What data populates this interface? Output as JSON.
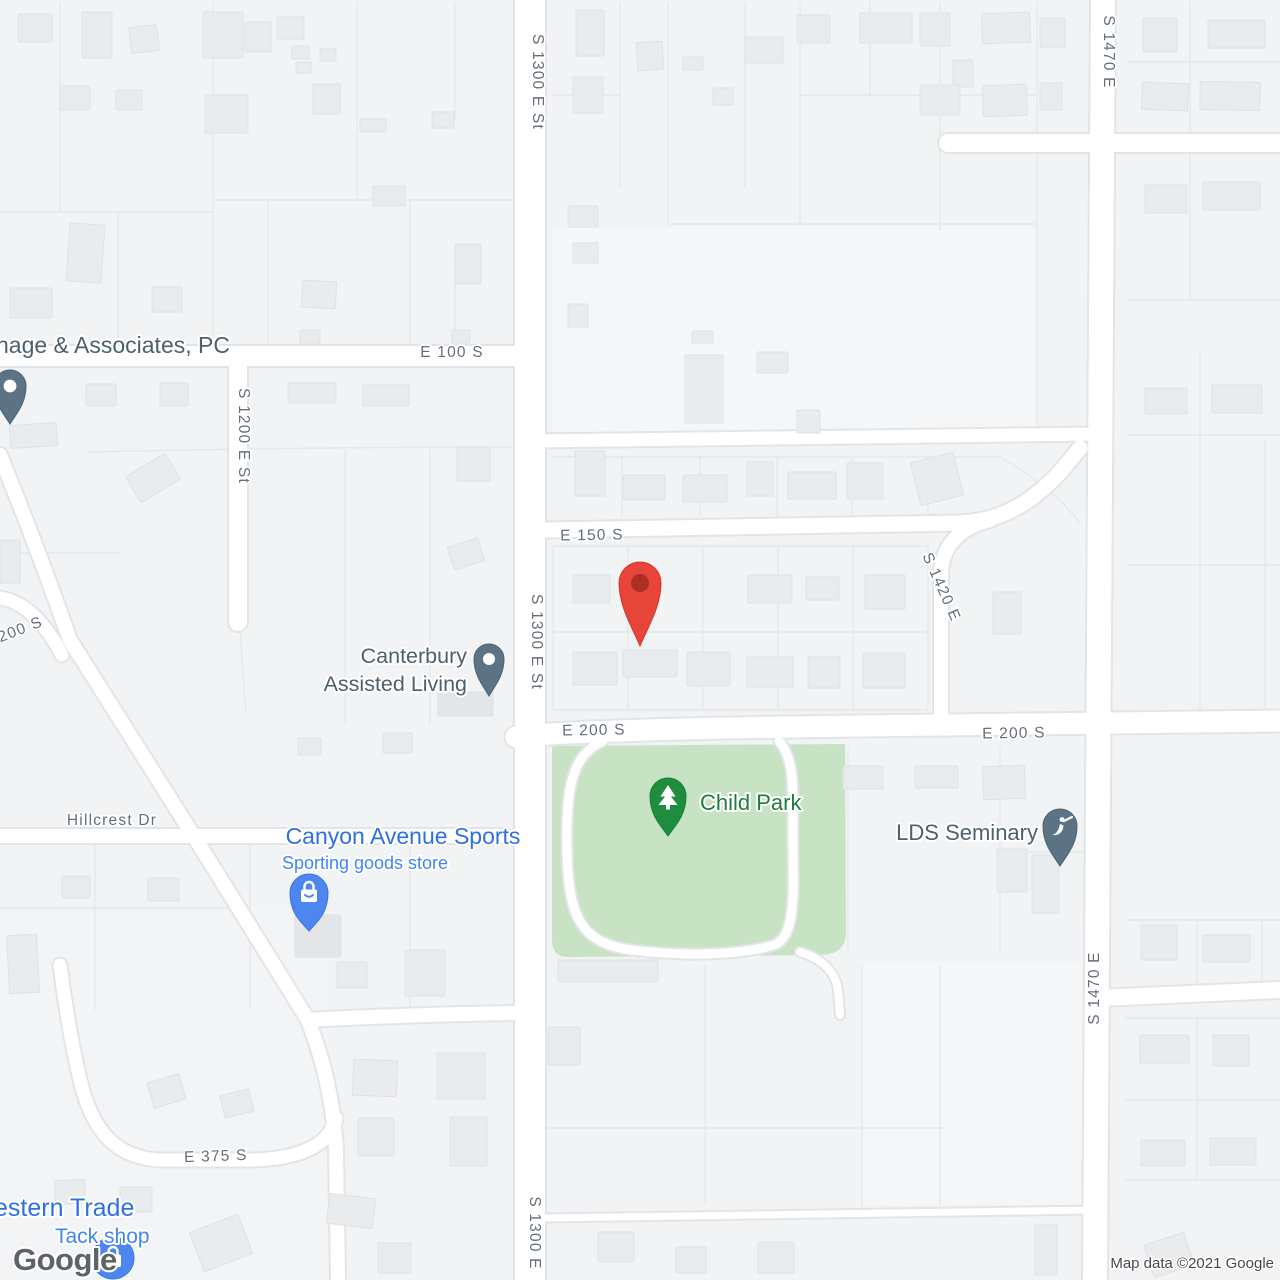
{
  "map": {
    "colors": {
      "bg": "#f1f3f4",
      "zoneLight": "#f6f7f8",
      "parcel": "#e5e8ea",
      "casing": "#e2e5e8",
      "road": "#ffffff",
      "park": "#c8e3c3",
      "building": "#eaebed",
      "buildingStroke": "#dfe1e4",
      "buildingDark": "#e3e5e7",
      "streetLabel": "#646e78",
      "halo": "#ffffff",
      "poiSlate": "#4d606c",
      "poiGreen": "#1e7d3c",
      "poiBlue": "#2f6fe0",
      "poiBlueLight": "#4285f4",
      "pinSlate": "#5b7384",
      "pinSlateStroke": "#4c6170",
      "pinGreen": "#1e8e3e",
      "pinGreenStroke": "#17803a",
      "pinBlue": "#4e86f0",
      "pinBlueStroke": "#3a74e0",
      "markerRed": "#e8453a",
      "markerRedStroke": "#d03b2e",
      "markerRedInner": "#ad2e24",
      "logoGray": "#5f6368",
      "attribution": "#45494d"
    },
    "zones": [
      {
        "x": 553,
        "y": 228,
        "w": 484,
        "h": 204,
        "f": "#f5f6f7"
      },
      {
        "x": 862,
        "y": 962,
        "w": 226,
        "h": 243,
        "f": "#f5f6f7"
      },
      {
        "x": 0,
        "y": 908,
        "w": 328,
        "h": 372,
        "f": "#f3f4f6"
      }
    ],
    "parcel_lines": [
      "M60,2V212",
      "M213,2V343",
      "M357,2V200",
      "M455,2V120",
      "M0,212H213",
      "M213,200H516",
      "M118,212V345",
      "M268,200V345",
      "M410,200V345",
      "M455,260V345",
      "M88,452C220,449 390,447 516,447",
      "M345,450V725",
      "M430,450V725",
      "M240,622C242,668 244,690 246,712",
      "M0,553H120",
      "M0,908H250",
      "M95,844V1010",
      "M250,844V1008",
      "M410,844V1010",
      "M553,457H1002",
      "M622,457V517",
      "M700,457V517",
      "M777,457V517",
      "M852,457V517",
      "M928,457V517",
      "M1003,459C1040,480 1062,500 1080,523",
      "M553,546H928",
      "M553,546V710",
      "M628,546V710",
      "M703,546V710",
      "M778,546V710",
      "M853,546V710",
      "M928,546V710",
      "M553,632H928",
      "M553,710H928",
      "M620,2V188",
      "M668,2V224",
      "M745,2V188",
      "M800,2V224",
      "M870,2V95",
      "M940,2V230",
      "M1037,2V432",
      "M668,224H1037",
      "M800,95H1037",
      "M553,95H620",
      "M1128,62H1280",
      "M1190,2V138",
      "M1128,300H1280",
      "M1190,152V300",
      "M1128,435H1280",
      "M1200,350V715",
      "M1128,565H1280",
      "M1265,440V715",
      "M1125,920H1280",
      "M1197,920V993",
      "M1262,920V993",
      "M1125,1018H1280",
      "M1197,1018V1098",
      "M1125,1100H1280",
      "M1197,1100V1180",
      "M1125,1180H1280",
      "M545,1128H945",
      "M705,965V1205",
      "M862,965V1205",
      "M940,965V1205",
      "M1000,748V952",
      "M1000,852H1092",
      "M848,748V952"
    ],
    "park": {
      "d": "M552,746 L845,744 L846,930 C846,948 838,954 820,955 L568,957 C556,957 552,950 552,938 Z"
    },
    "roads": [
      {
        "d": "M530,0 V1280",
        "w": 30
      },
      {
        "d": "M1103,0 L1095,1280",
        "w": 24
      },
      {
        "d": "M0,356 H516",
        "w": 20
      },
      {
        "d": "M948,143 H1280",
        "w": 18
      },
      {
        "d": "M530,441 L1100,434",
        "w": 13
      },
      {
        "d": "M545,530 L960,523 C1000,521 1030,505 1062,470 L1080,448",
        "w": 15
      },
      {
        "d": "M941,716 V575 C941,548 958,528 990,520",
        "w": 14
      },
      {
        "d": "M516,737 C560,731 700,728 860,726 L1280,721",
        "w": 21
      },
      {
        "d": "M238,357 V622",
        "w": 18
      },
      {
        "d": "M0,836 H505",
        "w": 14
      },
      {
        "d": "M0,455 C30,530 45,570 70,640 L210,862 L308,1020",
        "w": 14
      },
      {
        "d": "M0,598 C25,602 45,622 62,655",
        "w": 13
      },
      {
        "d": "M308,1020 C380,1016 450,1014 516,1013",
        "w": 14
      },
      {
        "d": "M308,1020 C325,1065 333,1100 336,1150 L338,1280",
        "w": 14
      },
      {
        "d": "M336,1118 C330,1146 300,1158 255,1160 L160,1160 C115,1158 92,1130 80,1080 C72,1045 65,1005 60,965",
        "w": 13
      },
      {
        "d": "M1099,998 L1280,990",
        "w": 16
      },
      {
        "d": "M545,1218 L1097,1210",
        "w": 7
      },
      {
        "d": "M603,741 C571,755 566,790 567,848 C568,912 578,940 625,949 C685,958 745,954 774,945 C794,938 794,900 793,852 C792,795 797,762 779,741",
        "w": 9
      },
      {
        "d": "M800,952 C820,958 835,970 838,990 L840,1015",
        "w": 8
      }
    ],
    "buildings": [
      [
        18,
        14,
        34,
        28,
        0
      ],
      [
        82,
        12,
        30,
        46,
        0
      ],
      [
        130,
        26,
        28,
        26,
        -7
      ],
      [
        203,
        12,
        40,
        46,
        0
      ],
      [
        245,
        22,
        26,
        30,
        0
      ],
      [
        277,
        17,
        27,
        22,
        0
      ],
      [
        292,
        46,
        17,
        13,
        0
      ],
      [
        320,
        49,
        16,
        12,
        0
      ],
      [
        296,
        62,
        15,
        11,
        0
      ],
      [
        60,
        86,
        30,
        24,
        0
      ],
      [
        116,
        90,
        26,
        20,
        0
      ],
      [
        205,
        95,
        43,
        38,
        0
      ],
      [
        313,
        84,
        27,
        30,
        0
      ],
      [
        360,
        119,
        26,
        13,
        0
      ],
      [
        432,
        112,
        22,
        16,
        0
      ],
      [
        373,
        186,
        32,
        20,
        0
      ],
      [
        68,
        224,
        35,
        58,
        4
      ],
      [
        10,
        288,
        42,
        30,
        0
      ],
      [
        152,
        287,
        30,
        25,
        0
      ],
      [
        302,
        281,
        34,
        27,
        3
      ],
      [
        455,
        244,
        26,
        40,
        0
      ],
      [
        300,
        330,
        20,
        13,
        0
      ],
      [
        452,
        330,
        18,
        13,
        0
      ],
      [
        86,
        384,
        30,
        22,
        0
      ],
      [
        160,
        383,
        28,
        23,
        0
      ],
      [
        288,
        383,
        48,
        20,
        0
      ],
      [
        363,
        385,
        46,
        21,
        0
      ],
      [
        10,
        424,
        47,
        23,
        -4
      ],
      [
        130,
        463,
        46,
        30,
        -31
      ],
      [
        457,
        447,
        33,
        34,
        0
      ],
      [
        0,
        540,
        20,
        43,
        0
      ],
      [
        450,
        542,
        32,
        24,
        -18
      ],
      [
        298,
        738,
        23,
        17,
        0
      ],
      [
        383,
        733,
        29,
        20,
        0
      ],
      [
        8,
        935,
        30,
        58,
        -3
      ],
      [
        62,
        876,
        28,
        22,
        0
      ],
      [
        148,
        878,
        31,
        23,
        0
      ],
      [
        295,
        915,
        46,
        42,
        0,
        1
      ],
      [
        150,
        1078,
        33,
        26,
        -17
      ],
      [
        222,
        1092,
        30,
        23,
        -14
      ],
      [
        55,
        1180,
        30,
        24,
        -2
      ],
      [
        120,
        1187,
        32,
        25,
        0
      ],
      [
        195,
        1222,
        52,
        42,
        -21
      ],
      [
        378,
        1243,
        33,
        30,
        0
      ],
      [
        337,
        962,
        30,
        26,
        0
      ],
      [
        405,
        950,
        40,
        46,
        0
      ],
      [
        353,
        1060,
        44,
        36,
        2
      ],
      [
        437,
        1053,
        48,
        46,
        0
      ],
      [
        358,
        1118,
        36,
        38,
        0
      ],
      [
        450,
        1117,
        37,
        49,
        0
      ],
      [
        328,
        1196,
        46,
        30,
        7
      ],
      [
        576,
        10,
        28,
        46,
        0
      ],
      [
        637,
        42,
        26,
        28,
        -4
      ],
      [
        683,
        57,
        20,
        13,
        0
      ],
      [
        745,
        37,
        38,
        26,
        0
      ],
      [
        797,
        15,
        33,
        28,
        0
      ],
      [
        860,
        13,
        52,
        30,
        0
      ],
      [
        920,
        13,
        30,
        33,
        0
      ],
      [
        982,
        13,
        48,
        30,
        -2
      ],
      [
        573,
        77,
        30,
        36,
        0
      ],
      [
        713,
        88,
        20,
        17,
        0
      ],
      [
        953,
        60,
        20,
        27,
        0
      ],
      [
        920,
        85,
        40,
        30,
        0
      ],
      [
        983,
        85,
        44,
        31,
        -2
      ],
      [
        568,
        206,
        30,
        21,
        0
      ],
      [
        573,
        243,
        25,
        20,
        0
      ],
      [
        568,
        304,
        20,
        23,
        0
      ],
      [
        692,
        331,
        21,
        12,
        0
      ],
      [
        757,
        352,
        31,
        21,
        0
      ],
      [
        685,
        355,
        38,
        68,
        0
      ],
      [
        797,
        410,
        23,
        23,
        0
      ],
      [
        1040,
        18,
        25,
        29,
        0
      ],
      [
        1143,
        18,
        34,
        34,
        0
      ],
      [
        1208,
        20,
        57,
        28,
        0
      ],
      [
        1040,
        83,
        22,
        27,
        0
      ],
      [
        1142,
        83,
        46,
        27,
        2
      ],
      [
        1200,
        82,
        60,
        28,
        1
      ],
      [
        1145,
        185,
        42,
        28,
        0
      ],
      [
        1203,
        182,
        57,
        28,
        0
      ],
      [
        1145,
        388,
        42,
        26,
        0
      ],
      [
        1212,
        385,
        50,
        28,
        0
      ],
      [
        915,
        457,
        44,
        44,
        -14
      ],
      [
        993,
        592,
        28,
        42,
        0
      ],
      [
        575,
        451,
        30,
        45,
        0
      ],
      [
        623,
        475,
        42,
        25,
        0
      ],
      [
        683,
        475,
        44,
        27,
        0
      ],
      [
        747,
        462,
        26,
        34,
        0
      ],
      [
        788,
        472,
        48,
        27,
        0
      ],
      [
        847,
        463,
        36,
        36,
        0
      ],
      [
        573,
        575,
        37,
        28,
        0
      ],
      [
        748,
        575,
        44,
        28,
        0
      ],
      [
        806,
        577,
        33,
        23,
        0
      ],
      [
        865,
        575,
        40,
        34,
        0
      ],
      [
        573,
        652,
        44,
        33,
        0
      ],
      [
        623,
        650,
        54,
        27,
        0
      ],
      [
        687,
        652,
        43,
        34,
        0
      ],
      [
        747,
        657,
        46,
        30,
        0
      ],
      [
        808,
        657,
        32,
        31,
        0
      ],
      [
        863,
        653,
        42,
        35,
        0
      ],
      [
        438,
        692,
        55,
        24,
        0,
        1
      ],
      [
        843,
        766,
        40,
        23,
        0
      ],
      [
        915,
        766,
        43,
        22,
        0
      ],
      [
        983,
        766,
        42,
        33,
        -2
      ],
      [
        997,
        849,
        30,
        43,
        0
      ],
      [
        1032,
        855,
        27,
        58,
        0
      ],
      [
        1141,
        925,
        36,
        35,
        0
      ],
      [
        1203,
        935,
        47,
        27,
        0
      ],
      [
        1140,
        1035,
        49,
        28,
        0
      ],
      [
        1213,
        1035,
        36,
        31,
        0
      ],
      [
        1141,
        1140,
        44,
        26,
        0
      ],
      [
        1210,
        1138,
        46,
        27,
        0
      ],
      [
        1148,
        1238,
        42,
        34,
        -18
      ],
      [
        558,
        960,
        100,
        22,
        0
      ],
      [
        548,
        1027,
        32,
        38,
        0
      ],
      [
        598,
        1232,
        36,
        30,
        0
      ],
      [
        676,
        1247,
        30,
        26,
        0
      ],
      [
        758,
        1242,
        36,
        31,
        0
      ],
      [
        1035,
        1225,
        22,
        50,
        0
      ]
    ],
    "street_labels": [
      {
        "text": "S 1300 E St",
        "x": 533,
        "y": 82,
        "rot": 90
      },
      {
        "text": "E 100 S",
        "x": 452,
        "y": 357,
        "rot": 0
      },
      {
        "text": "S 1200 E St",
        "x": 239,
        "y": 436,
        "rot": 90
      },
      {
        "text": "E 150 S",
        "x": 592,
        "y": 540,
        "rot": -1
      },
      {
        "text": "S 1420 E",
        "x": 937,
        "y": 589,
        "rot": 66
      },
      {
        "text": "S 1300 E St",
        "x": 532,
        "y": 642,
        "rot": 90
      },
      {
        "text": "E 200 S",
        "x": 594,
        "y": 735,
        "rot": -1
      },
      {
        "text": "E 200 S",
        "x": 1014,
        "y": 738,
        "rot": -1
      },
      {
        "text": "200 S",
        "x": 22,
        "y": 634,
        "rot": -21
      },
      {
        "text": "Hillcrest Dr",
        "x": 112,
        "y": 825,
        "rot": 0
      },
      {
        "text": "S 1470 E",
        "x": 1104,
        "y": 52,
        "rot": 90
      },
      {
        "text": "S 1470 E",
        "x": 1099,
        "y": 988,
        "rot": -90
      },
      {
        "text": "E 375 S",
        "x": 216,
        "y": 1161,
        "rot": -2
      },
      {
        "text": "S 1300 E",
        "x": 530,
        "y": 1233,
        "rot": 90
      }
    ],
    "pins": [
      {
        "kind": "slate",
        "glyph": "dot",
        "cx": 10,
        "cy": 386,
        "r": 16,
        "tip": 424,
        "name": "associates-pin"
      },
      {
        "kind": "slate",
        "glyph": "dot",
        "cx": 489,
        "cy": 659,
        "r": 15,
        "tip": 696,
        "name": "canterbury-pin"
      },
      {
        "kind": "slate",
        "glyph": "angel",
        "cx": 1060,
        "cy": 826,
        "r": 17,
        "tip": 866,
        "name": "lds-seminary-pin"
      },
      {
        "kind": "green",
        "glyph": "tree",
        "cx": 668,
        "cy": 796,
        "r": 18,
        "tip": 836,
        "name": "child-park-pin"
      },
      {
        "kind": "blue",
        "glyph": "bag",
        "cx": 309,
        "cy": 893,
        "r": 19,
        "tip": 931,
        "name": "canyon-sports-pin"
      },
      {
        "kind": "blue-circle",
        "glyph": "bag",
        "cx": 113,
        "cy": 1258,
        "r": 21,
        "name": "tack-shop-pin"
      },
      {
        "kind": "red",
        "cx": 640,
        "cy": 583,
        "r": 21,
        "tip": 646,
        "name": "location-marker"
      }
    ],
    "poi_labels": [
      {
        "text": "nage & Associates, PC",
        "x": -4,
        "y": 353,
        "size": 23,
        "color": "poiSlate",
        "anchor": "start",
        "name": "associates-label"
      },
      {
        "text": "Canterbury",
        "x": 467,
        "y": 663,
        "size": 21.5,
        "color": "poiSlate",
        "anchor": "end",
        "name": "canterbury-label-line1"
      },
      {
        "text": "Assisted Living",
        "x": 467,
        "y": 691,
        "size": 21.5,
        "color": "poiSlate",
        "anchor": "end",
        "name": "canterbury-label-line2"
      },
      {
        "text": "Child Park",
        "x": 700,
        "y": 810,
        "size": 22,
        "color": "poiGreen",
        "anchor": "start",
        "name": "child-park-label"
      },
      {
        "text": "LDS Seminary",
        "x": 1038,
        "y": 840,
        "size": 22,
        "color": "poiSlate",
        "anchor": "end",
        "name": "lds-seminary-label"
      },
      {
        "text": "Canyon Avenue Sports",
        "x": 403,
        "y": 844,
        "size": 23,
        "color": "poiBlue",
        "anchor": "middle",
        "name": "canyon-sports-label"
      },
      {
        "text": "Sporting goods store",
        "x": 365,
        "y": 869,
        "size": 18,
        "color": "poiBlueLight",
        "anchor": "middle",
        "name": "canyon-sports-sublabel"
      },
      {
        "text": "estern Trade",
        "x": -6,
        "y": 1216,
        "size": 25,
        "color": "poiBlue",
        "anchor": "start",
        "name": "western-trade-label"
      },
      {
        "text": "Tack shop",
        "x": 55,
        "y": 1243,
        "size": 21,
        "color": "poiBlueLight",
        "anchor": "start",
        "name": "tack-shop-label"
      }
    ],
    "attribution": {
      "logo": "Google",
      "text": "Map data ©2021 Google"
    }
  }
}
